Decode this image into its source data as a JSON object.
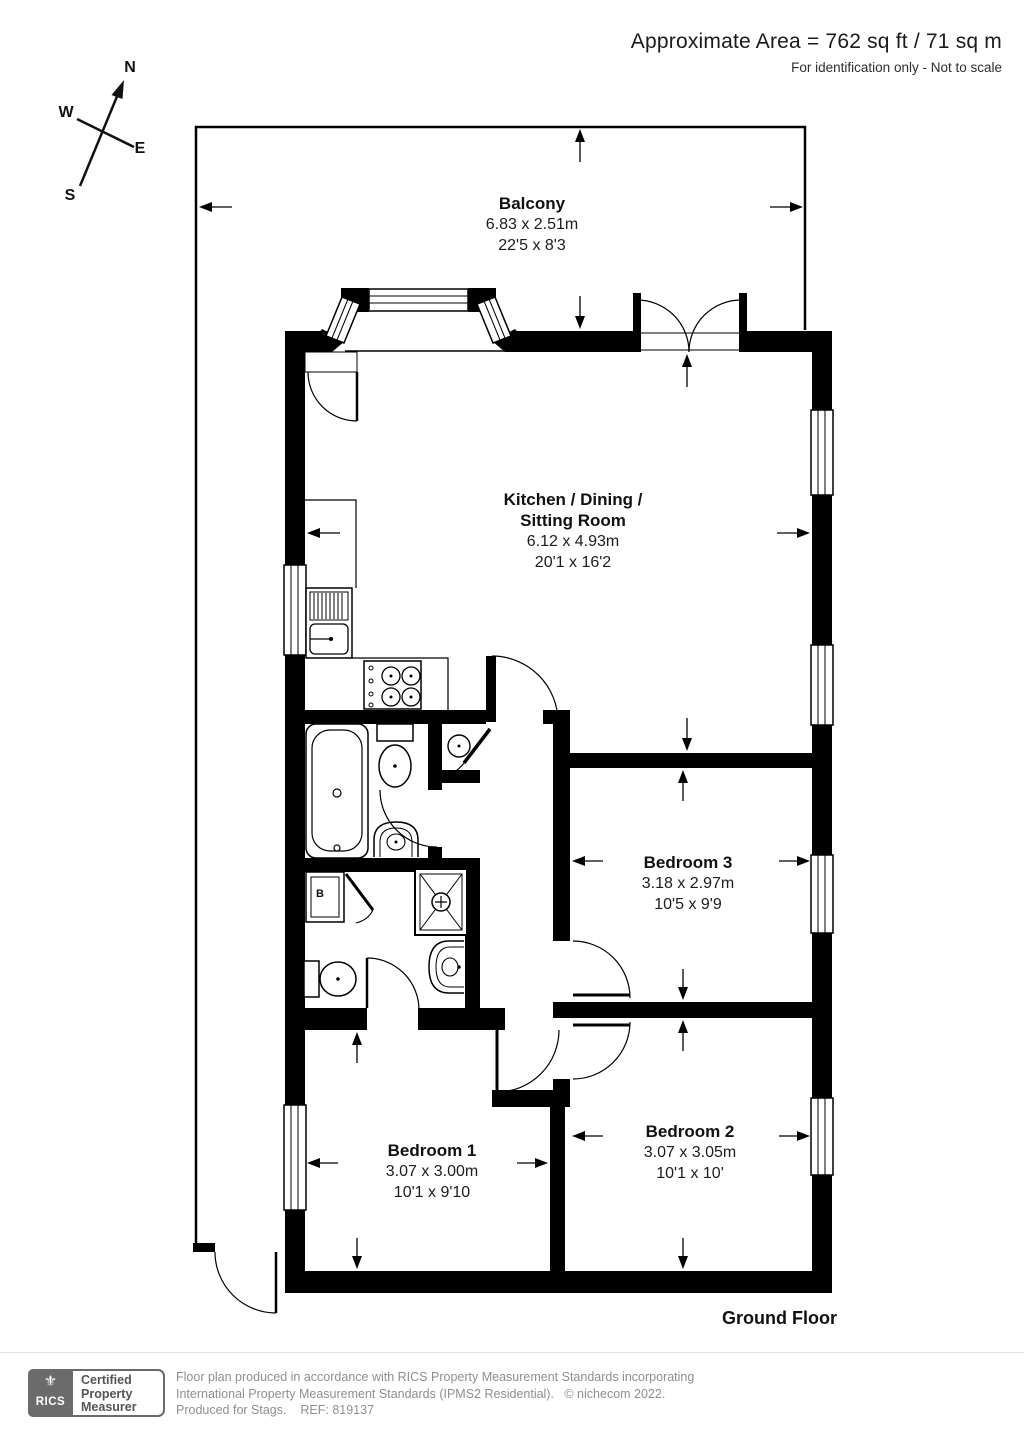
{
  "header": {
    "area": "Approximate Area = 762 sq ft / 71 sq m",
    "disclaimer": "For identification only - Not to scale"
  },
  "compass": {
    "north": "N",
    "west": "W",
    "east": "E",
    "south": "S"
  },
  "rooms": {
    "balcony": {
      "name": "Balcony",
      "metric": "6.83 x 2.51m",
      "imperial": "22'5 x 8'3"
    },
    "kitchen": {
      "name": "Kitchen / Dining /\nSitting Room",
      "metric": "6.12 x 4.93m",
      "imperial": "20'1 x 16'2"
    },
    "bedroom3": {
      "name": "Bedroom 3",
      "metric": "3.18 x 2.97m",
      "imperial": "10'5 x 9'9"
    },
    "bedroom2": {
      "name": "Bedroom 2",
      "metric": "3.07 x 3.05m",
      "imperial": "10'1 x 10'"
    },
    "bedroom1": {
      "name": "Bedroom 1",
      "metric": "3.07 x 3.00m",
      "imperial": "10'1 x 9'10"
    }
  },
  "labels": {
    "boiler": "B",
    "floor": "Ground Floor"
  },
  "footer": {
    "logo_text": "RICS",
    "cert_line1": "Certified",
    "cert_line2": "Property",
    "cert_line3": "Measurer",
    "line1": "Floor plan produced in accordance with RICS Property Measurement Standards incorporating",
    "line2": "International Property Measurement Standards (IPMS2 Residential).   © nichecom 2022.",
    "line3": "Produced for Stags.    REF: 819137"
  },
  "colors": {
    "wall": "#000000",
    "logo_gray": "#6b6b6b",
    "muted_text": "#8f8f8f"
  }
}
